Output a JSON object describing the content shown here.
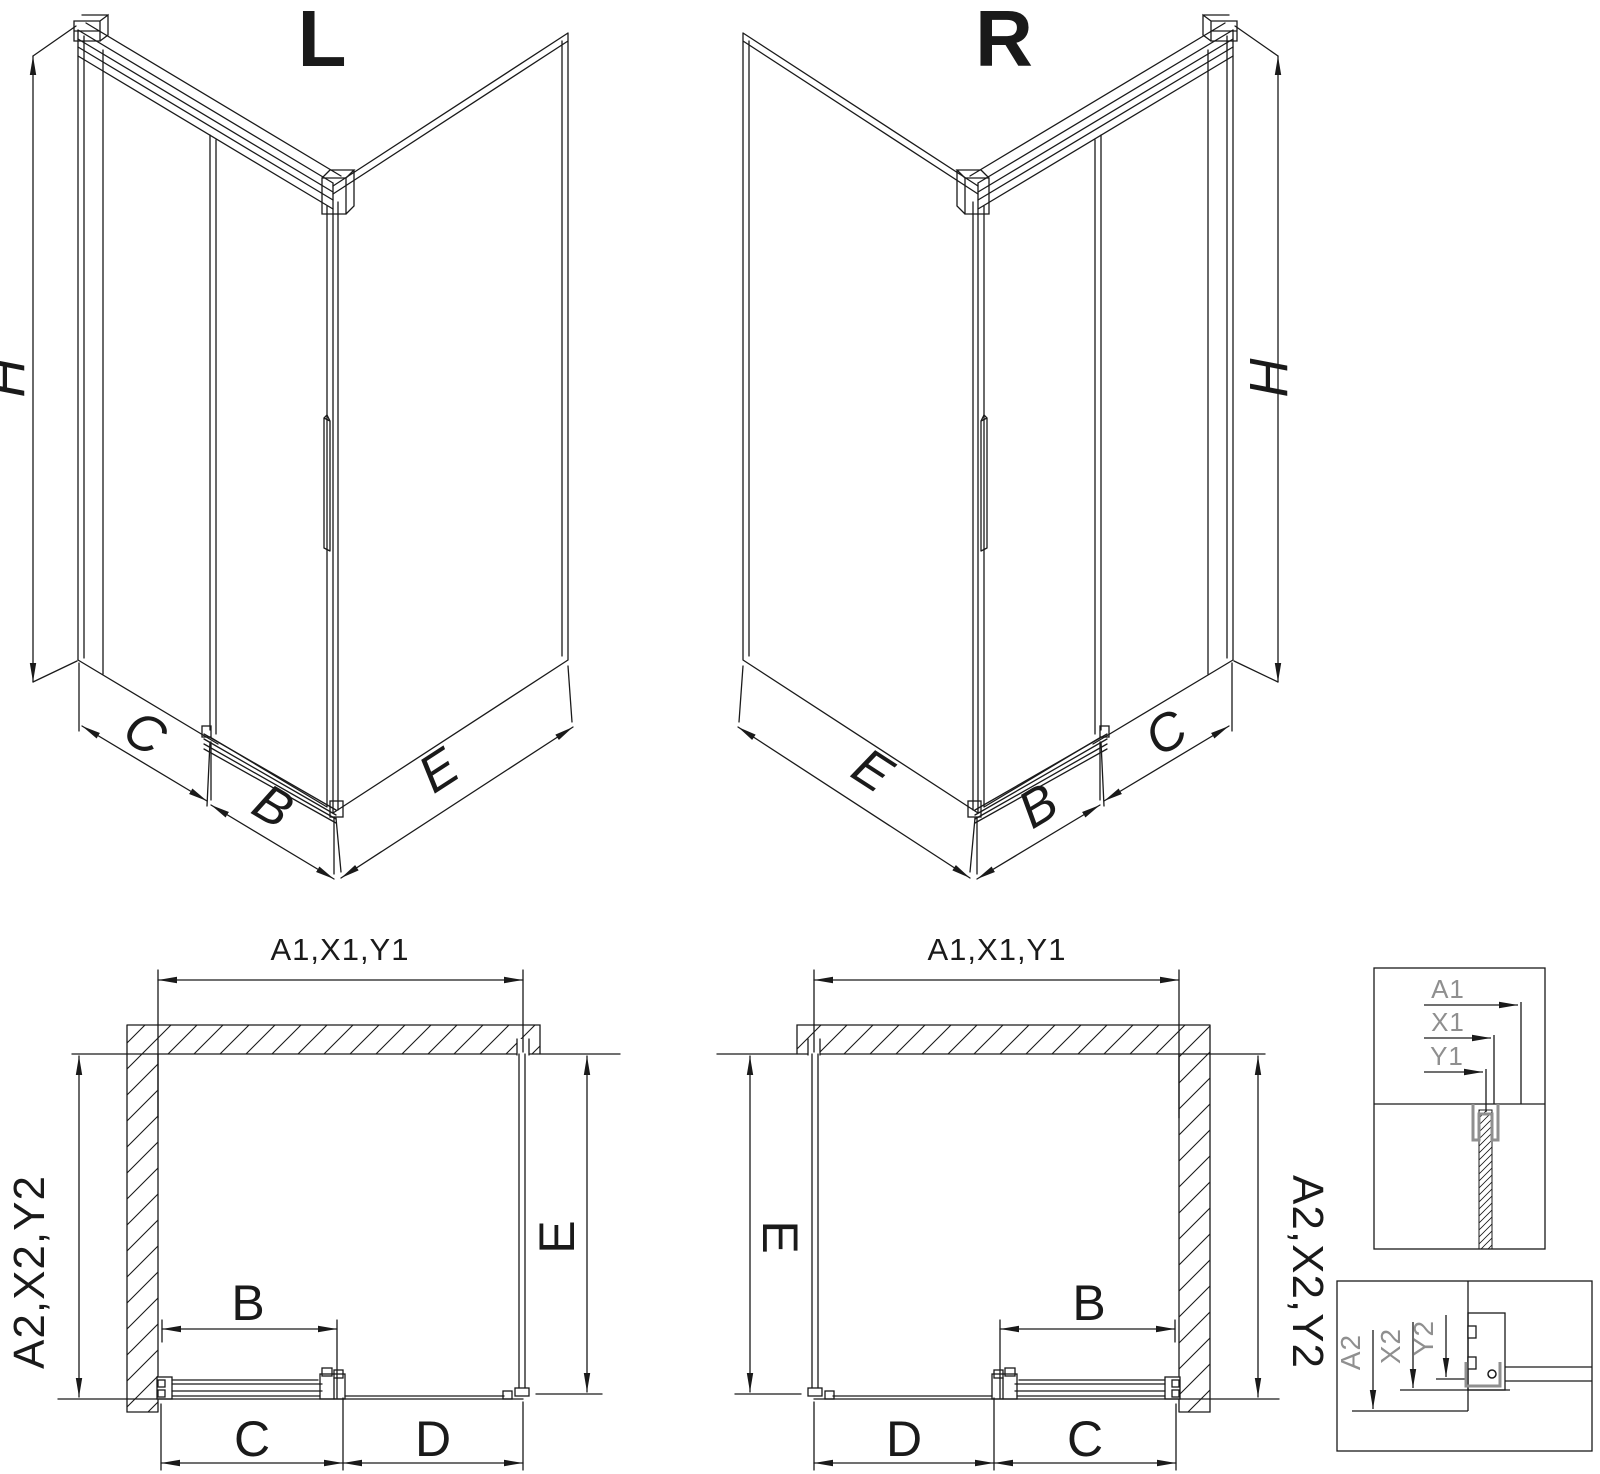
{
  "drawing": {
    "type": "technical-diagram",
    "subject": "corner shower enclosure with sliding door, left (L) and right (R) variants, isometric and plan views with detail callouts"
  },
  "colors": {
    "line": "#1a1a1a",
    "gray_detail": "#8f8f8f",
    "background": "#ffffff"
  },
  "iso_left": {
    "title": "L",
    "height_label": "H",
    "fixed_width_label": "C",
    "door_width_label": "B",
    "side_width_label": "E"
  },
  "iso_right": {
    "title": "R",
    "height_label": "H",
    "fixed_width_label": "C",
    "door_width_label": "B",
    "side_width_label": "E"
  },
  "plan_left": {
    "top_dim": "A1,X1,Y1",
    "side_dim": "A2,X2,Y2",
    "side_panel_label": "E",
    "door_label": "B",
    "fixed_label": "C",
    "opening_label": "D"
  },
  "plan_right": {
    "top_dim": "A1,X1,Y1",
    "side_dim": "A2,X2,Y2",
    "side_panel_label": "E",
    "door_label": "B",
    "fixed_label": "C",
    "opening_label": "D"
  },
  "detail_top_labels": [
    "A1",
    "X1",
    "Y1"
  ],
  "detail_bottom_labels": [
    "A2",
    "X2",
    "Y2"
  ]
}
